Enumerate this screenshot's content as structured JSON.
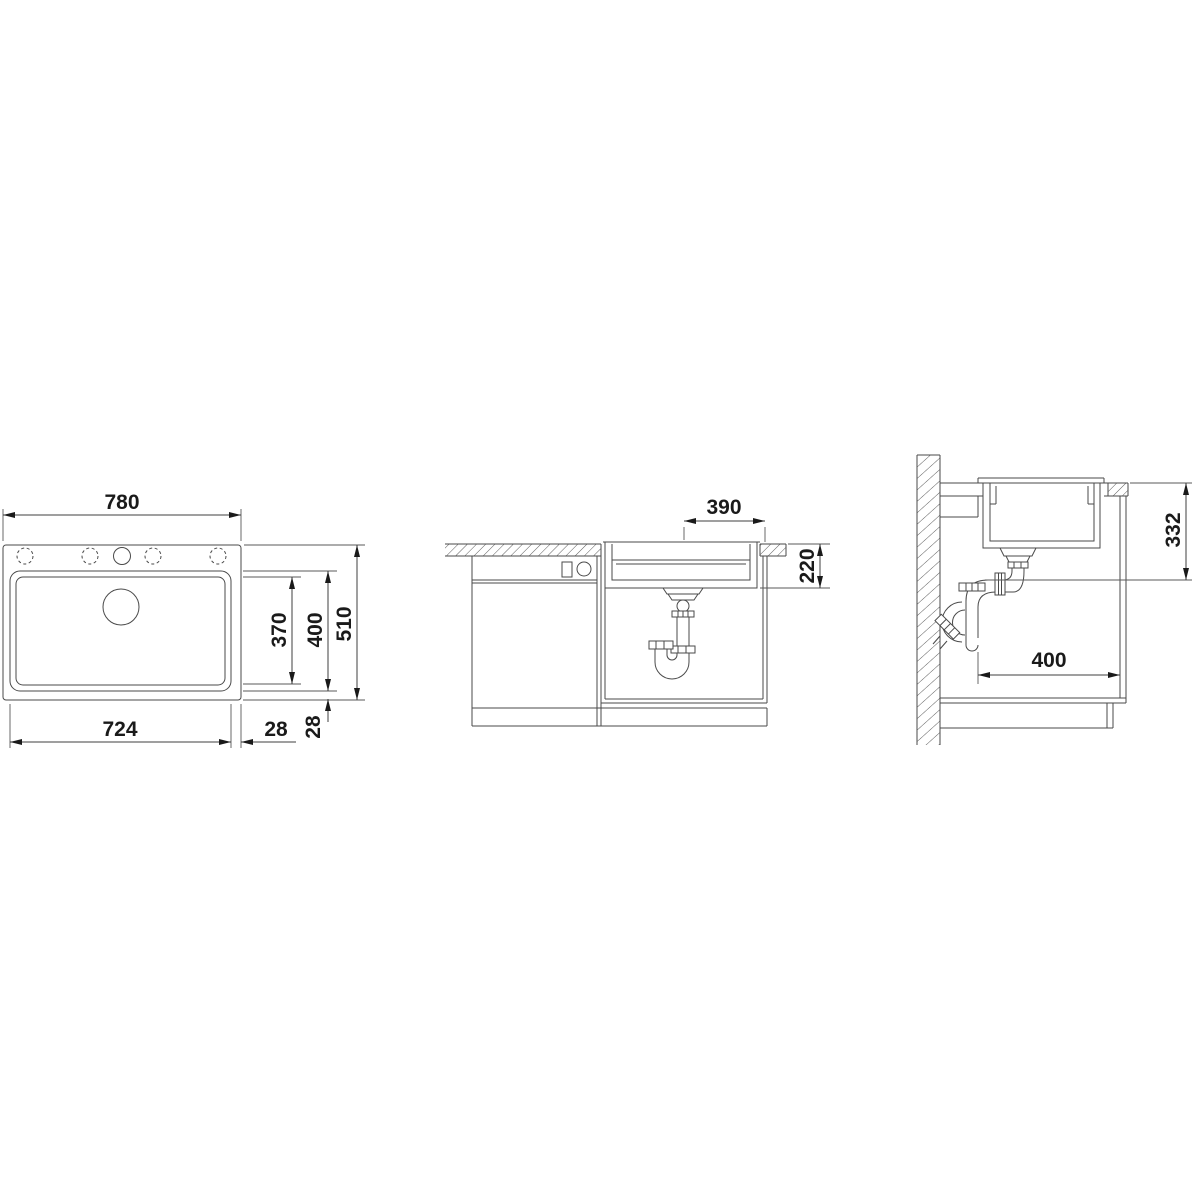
{
  "drawing": {
    "kind": "sink installation dimension drawing",
    "views": {
      "plan": {
        "dims": {
          "overall_width": "780",
          "overall_depth": "510",
          "bowl_width": "724",
          "bowl_depth": "400",
          "bowl_inner_depth": "370",
          "edge_right": "28",
          "edge_front": "28"
        }
      },
      "front_section": {
        "dims": {
          "drain_to_edge": "390",
          "bowl_height": "220"
        }
      },
      "side_section": {
        "dims": {
          "outlet_height": "332",
          "cabinet_inner_depth": "400"
        }
      }
    },
    "colors": {
      "background": "#ffffff",
      "line": "#4a4a4a",
      "dimension_text": "#1a1a1a"
    }
  }
}
